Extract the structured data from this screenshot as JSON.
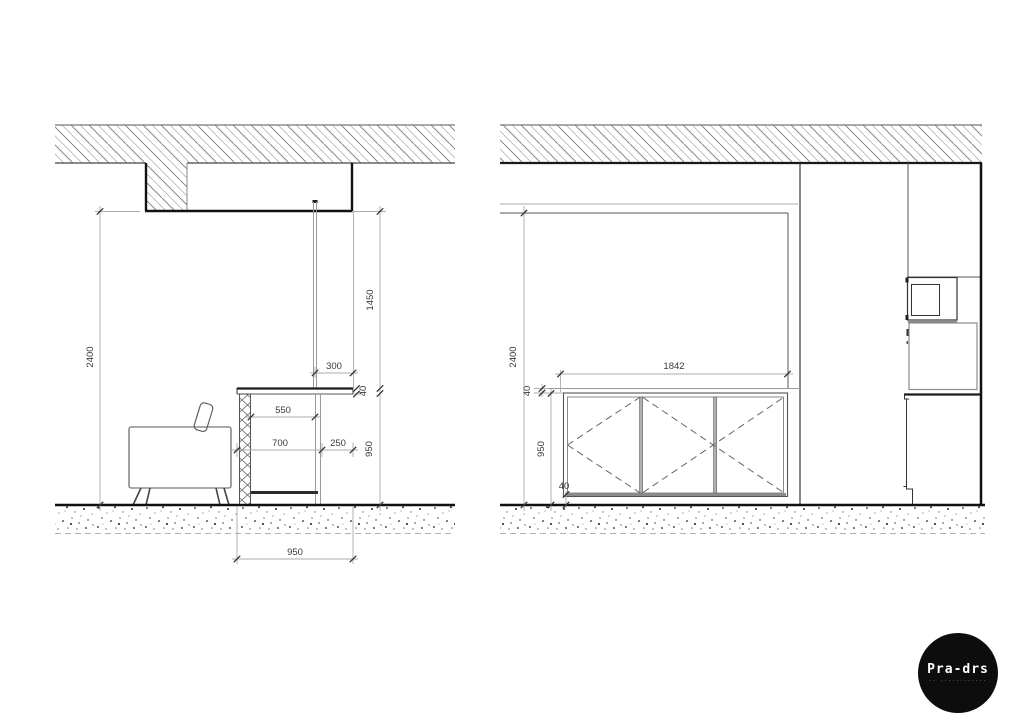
{
  "left_elevation": {
    "title": "desk-section",
    "dimensions": {
      "ceiling_height": "2400",
      "screen_height": "1450",
      "screen_offset": "300",
      "worktop_thickness": "40",
      "worktop_height": "950",
      "knee_clearance": "550",
      "desk_depth": "700",
      "overhang": "250",
      "base_width": "950"
    }
  },
  "right_elevation": {
    "title": "sideboard-section",
    "dimensions": {
      "ceiling_height": "2400",
      "sideboard_width": "1842",
      "top_thickness": "40",
      "sideboard_height": "950",
      "plinth_height": "40"
    }
  },
  "logo": {
    "brand": "Pra-drs",
    "tagline": "·· ············"
  },
  "colors": {
    "line_dark": "#111111",
    "line_mid": "#555555",
    "line_light": "#a6a6a6",
    "hatch": "#787878",
    "text": "#3a3a3a",
    "logo_bg": "#0d0d0d"
  }
}
